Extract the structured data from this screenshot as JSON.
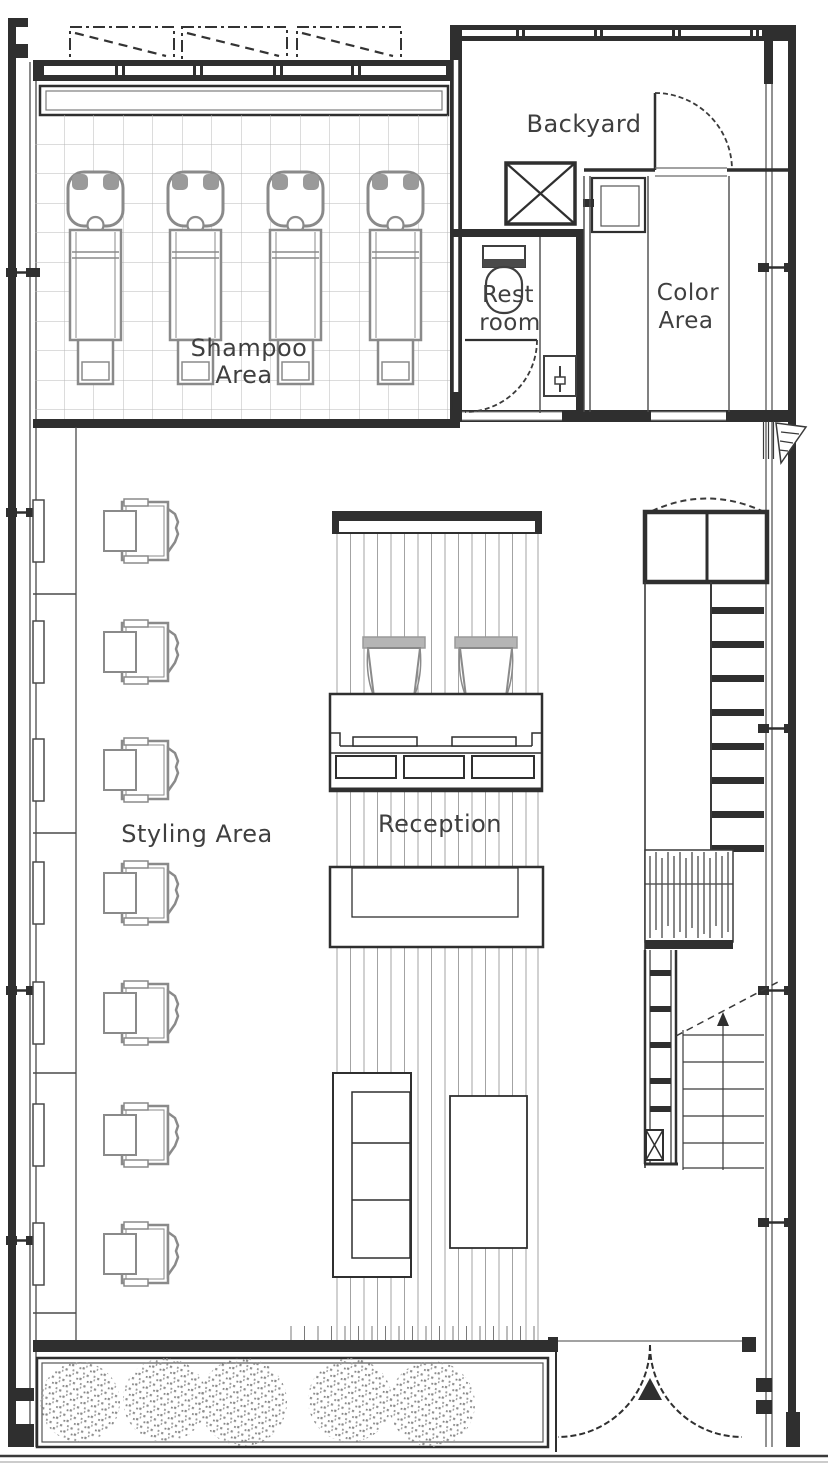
{
  "title": "Hair salon floor plan",
  "labels": {
    "shampoo_line1": "Shampoo",
    "shampoo_line2": "Area",
    "backyard": "Backyard",
    "restroom_line1": "Rest",
    "restroom_line2": "room",
    "color_line1": "Color",
    "color_line2": "Area",
    "styling": "Styling Area",
    "reception": "Reception"
  },
  "equipment": {
    "shampoo_stations": 4,
    "styling_chairs": 7,
    "reception_guest_chairs": 2,
    "waiting_sofa_seats": 3,
    "planter_shrubs": 5
  },
  "colors": {
    "ink": "#2f2f2f",
    "furniture_gray": "#8a8a8a",
    "grid_gray": "#b8b8b8",
    "deck_stripe": "#a3a3a3",
    "background": "#ffffff"
  }
}
